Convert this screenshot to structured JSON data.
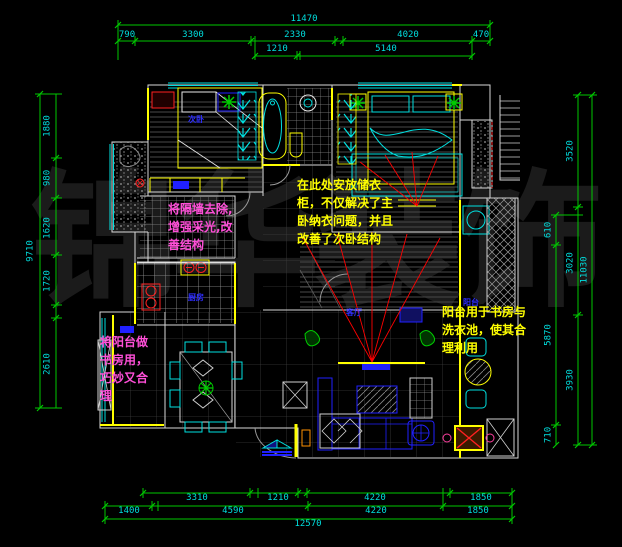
{
  "watermark": {
    "text": "锦华装饰"
  },
  "annotations": {
    "note1": {
      "lines": [
        "将隔墙去除,",
        "增强采光,改",
        "善结构"
      ]
    },
    "note2": {
      "lines": [
        "在此处安放储衣",
        "柜，不仅解决了主",
        "卧纳衣问题，并且",
        "改善了次卧结构"
      ]
    },
    "note3": {
      "lines": [
        "阳台用于书房与",
        "洗衣池，使其合",
        "理利用"
      ]
    },
    "note4": {
      "lines": [
        "将阳台做",
        "书房用，",
        "巧妙又合",
        "理"
      ]
    }
  },
  "room_labels": {
    "bedroom2": "次卧",
    "kitchen": "厨房",
    "living": "客厅",
    "balcony": "阳台"
  },
  "dimensions": {
    "top": {
      "overall": "11470",
      "row1": [
        "790",
        "3300",
        "2330",
        "4020",
        "470"
      ],
      "row2": [
        "1210",
        "5140"
      ]
    },
    "left": {
      "overall": "9710",
      "chain": [
        "1880",
        "980",
        "1620",
        "1720",
        "2610"
      ]
    },
    "right": {
      "overall": "11030",
      "outer": [
        "3520",
        "3020",
        "3930"
      ],
      "inner": [
        "610",
        "5870",
        "710"
      ]
    },
    "bottom": {
      "row1": [
        "3310",
        "1210",
        "4220",
        "1850"
      ],
      "row2": [
        "1400",
        "4590",
        "4220",
        "1850"
      ],
      "overall": "12570"
    }
  },
  "colors": {
    "dimension_line": "#00c800",
    "dimension_text": "#00dede",
    "wall": "#d8d8d8",
    "accent_yellow": "#ffff00",
    "accent_cyan": "#00e0e0",
    "furniture_blue": "#2020ff",
    "note_magenta": "#ff4fd8",
    "note_yellow": "#ffff00",
    "sightline_red": "#ff0000",
    "plant_green": "#00cc00"
  }
}
